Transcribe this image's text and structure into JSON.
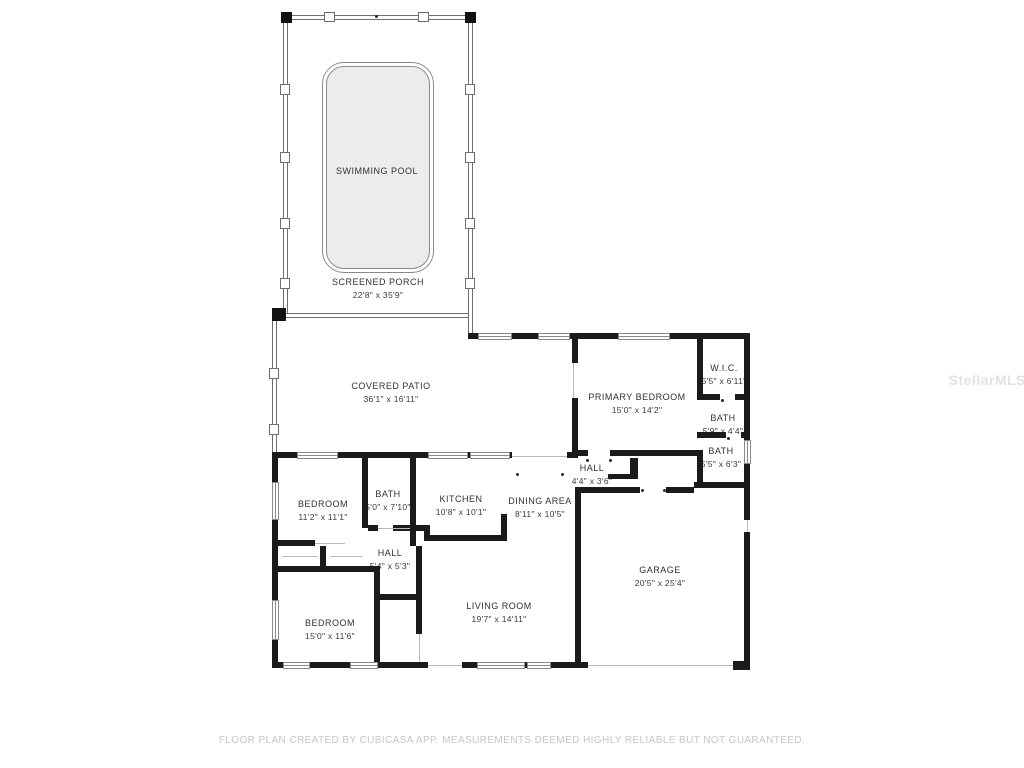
{
  "watermark": "StellarMLS",
  "footer": "FLOOR PLAN CREATED BY CUBICASA APP. MEASUREMENTS DEEMED HIGHLY RELIABLE BUT NOT GUARANTEED.",
  "rooms": [
    {
      "id": "swimming-pool",
      "name": "SWIMMING POOL",
      "dims": ""
    },
    {
      "id": "screened-porch",
      "name": "SCREENED PORCH",
      "dims": "22'8\" x 35'9\""
    },
    {
      "id": "covered-patio",
      "name": "COVERED PATIO",
      "dims": "36'1\" x 16'11\""
    },
    {
      "id": "primary-bedroom",
      "name": "PRIMARY BEDROOM",
      "dims": "15'0\" x 14'2\""
    },
    {
      "id": "wic",
      "name": "W.I.C.",
      "dims": "5'5\" x 6'11\""
    },
    {
      "id": "bath-upper",
      "name": "BATH",
      "dims": "5'9\" x 4'4\""
    },
    {
      "id": "bath-lower",
      "name": "BATH",
      "dims": "5'5\" x 6'3\""
    },
    {
      "id": "hall-right",
      "name": "HALL",
      "dims": "4'4\" x 3'6\""
    },
    {
      "id": "bedroom-left",
      "name": "BEDROOM",
      "dims": "11'2\" x 11'1\""
    },
    {
      "id": "bath-left",
      "name": "BATH",
      "dims": "5'0\" x 7'10\""
    },
    {
      "id": "kitchen",
      "name": "KITCHEN",
      "dims": "10'8\" x 10'1\""
    },
    {
      "id": "dining-area",
      "name": "DINING AREA",
      "dims": "8'11\" x 10'5\""
    },
    {
      "id": "hall-left",
      "name": "HALL",
      "dims": "5'4\" x 5'3\""
    },
    {
      "id": "bedroom-bottom",
      "name": "BEDROOM",
      "dims": "15'0\" x 11'6\""
    },
    {
      "id": "living-room",
      "name": "LIVING ROOM",
      "dims": "19'7\" x 14'11\""
    },
    {
      "id": "garage",
      "name": "GARAGE",
      "dims": "20'5\" x 25'4\""
    }
  ]
}
